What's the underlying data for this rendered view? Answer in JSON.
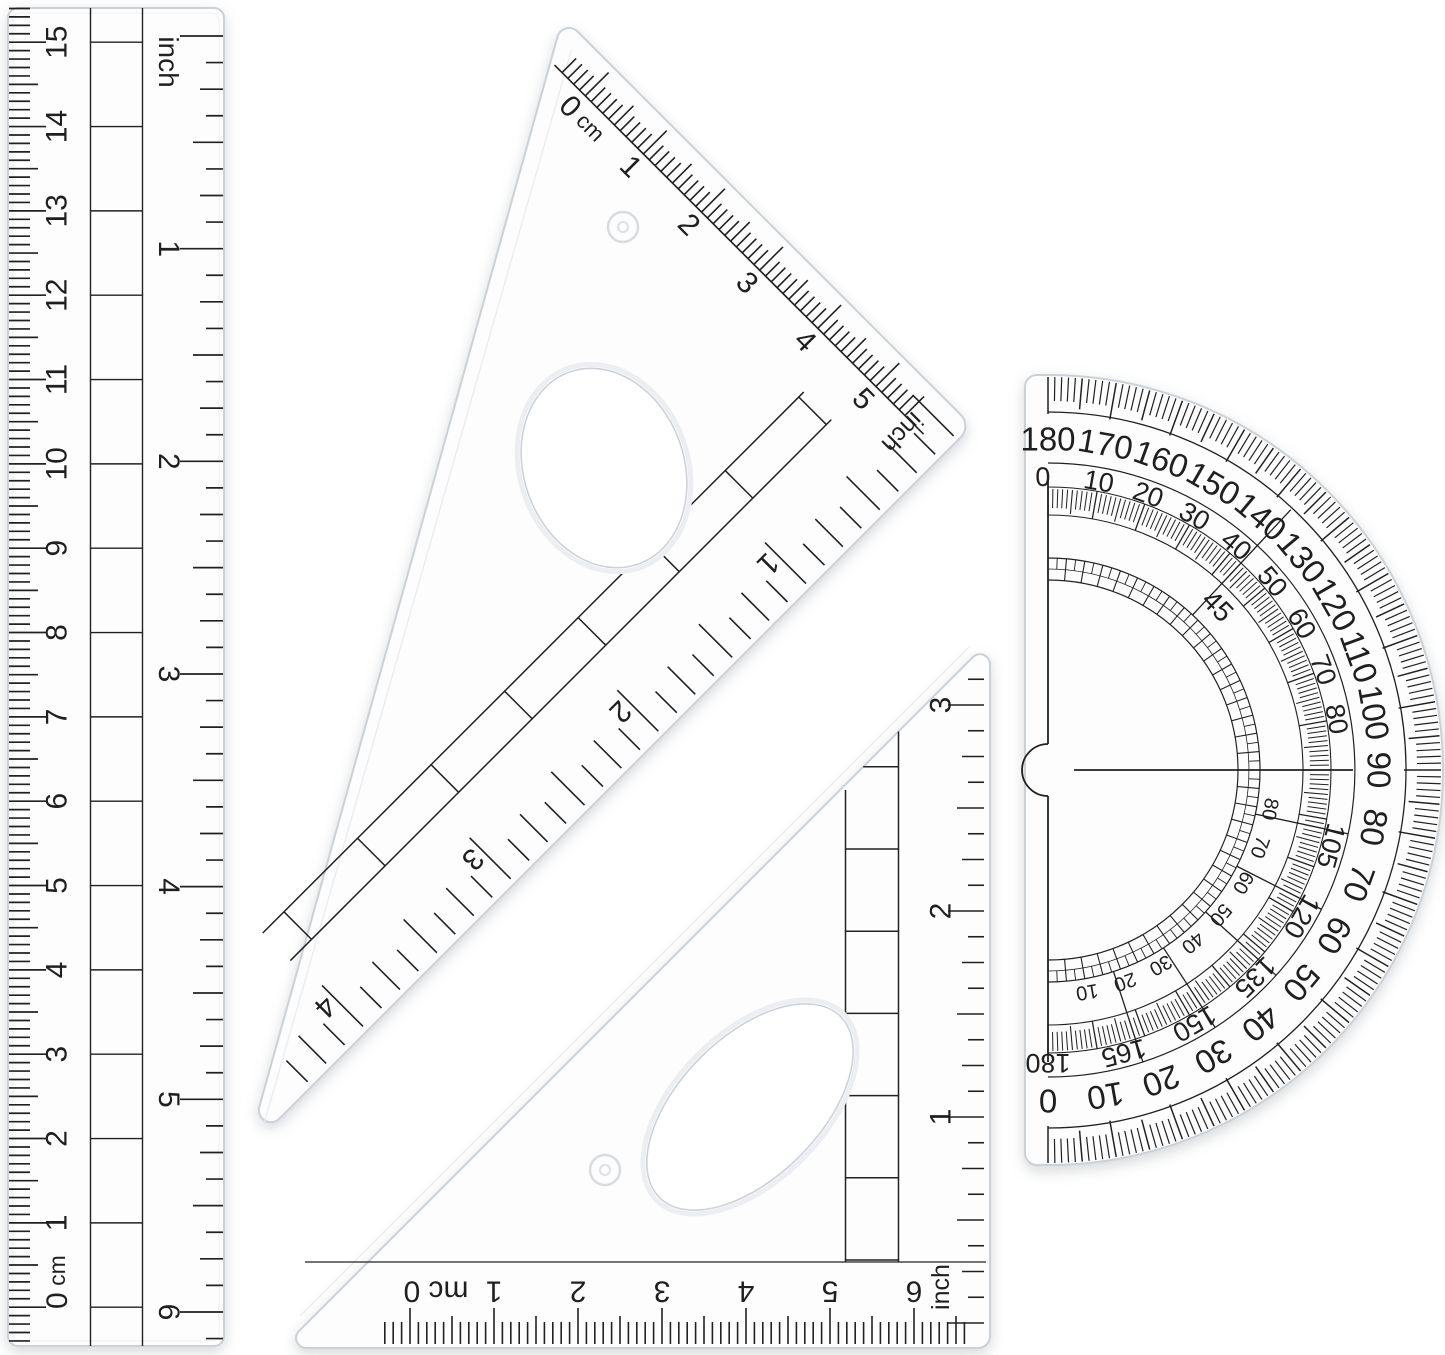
{
  "scene": {
    "background": "#ffffff",
    "ink": "#212121",
    "plastic_edge": "#ccd1d6"
  },
  "ruler": {
    "unit_inch_label": "inch",
    "zero_cm_label": "0 cm",
    "cm_labels": [
      "1",
      "2",
      "3",
      "4",
      "5",
      "6",
      "7",
      "8",
      "9",
      "10",
      "11",
      "12",
      "13",
      "14",
      "15"
    ],
    "inch_labels": [
      "1",
      "2",
      "3",
      "4",
      "5",
      "6"
    ]
  },
  "triangle_large": {
    "zero_cm_label": "0 cm",
    "cm_labels": [
      "1",
      "2",
      "3",
      "4",
      "5"
    ],
    "unit_inch_label": "inch",
    "inch_labels": [
      "1",
      "2",
      "3",
      "4"
    ]
  },
  "triangle_small": {
    "zero_cm_label": "0 cm",
    "cm_labels": [
      "1",
      "2",
      "3",
      "4",
      "5",
      "6"
    ],
    "unit_inch_label": "inch",
    "inch_labels": [
      "1",
      "2",
      "3"
    ]
  },
  "protractor": {
    "outer_labels": [
      "180",
      "170",
      "160",
      "150",
      "140",
      "130",
      "120",
      "110",
      "100",
      "90",
      "80",
      "70",
      "60",
      "50",
      "40",
      "30",
      "20",
      "10",
      "0"
    ],
    "inner_labels_upper": [
      "0",
      "10",
      "20",
      "30",
      "40",
      "50",
      "60",
      "70",
      "80"
    ],
    "inner_labels_lower": [
      "105",
      "120",
      "135",
      "150",
      "165",
      "180"
    ],
    "diagonal_label": "45",
    "inner_ladder_labels": [
      "10",
      "20",
      "30",
      "40",
      "50",
      "60",
      "70",
      "80"
    ]
  }
}
